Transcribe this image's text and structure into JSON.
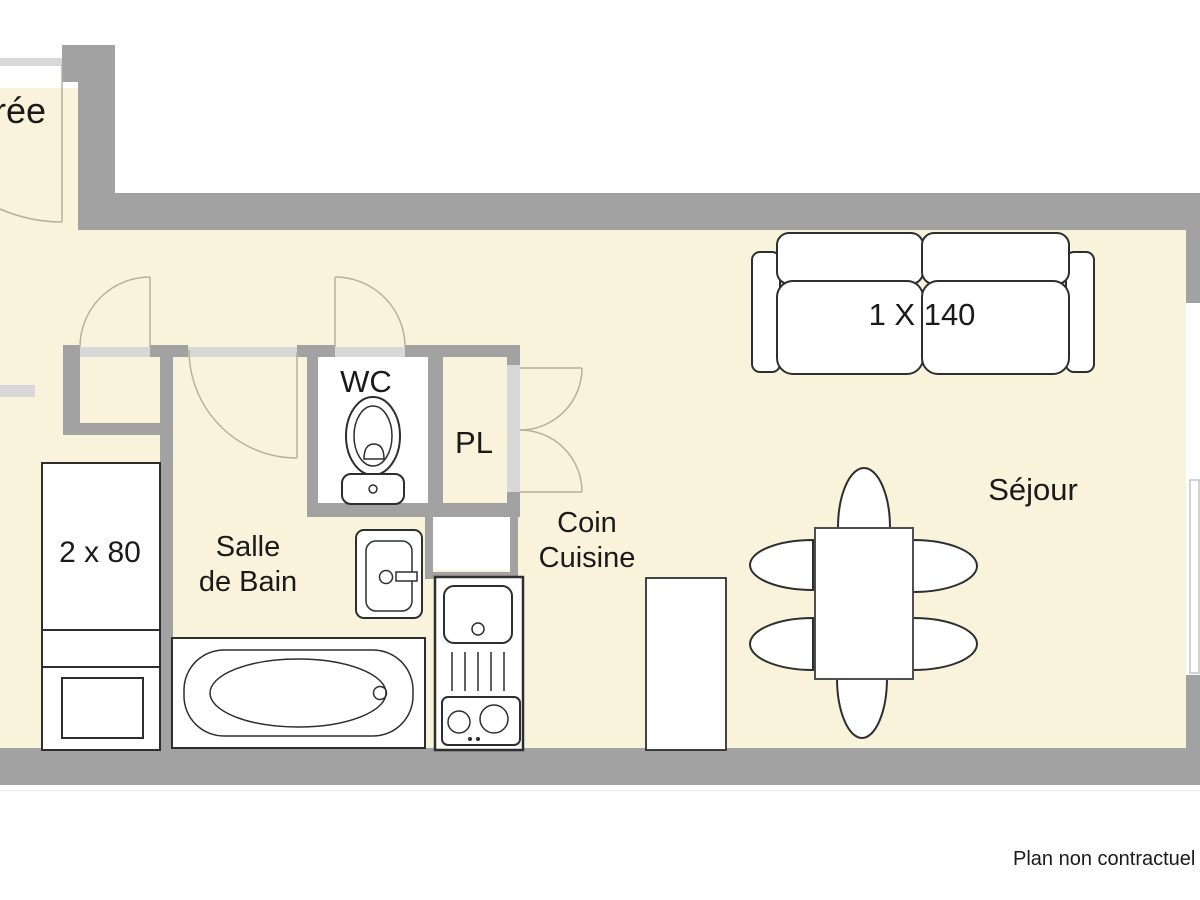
{
  "floorplan": {
    "rooms": {
      "entry": {
        "label": "rée"
      },
      "bedroom": {
        "bed_label": "2 x 80"
      },
      "bathroom": {
        "label_line1": "Salle",
        "label_line2": "de Bain"
      },
      "wc": {
        "label": "WC"
      },
      "closet": {
        "label": "PL"
      },
      "kitchen": {
        "label_line1": "Coin",
        "label_line2": "Cuisine"
      },
      "living_room": {
        "label": "Séjour",
        "sofa_label": "1 X 140"
      }
    },
    "footer": {
      "disclaimer": "Plan non contractuel"
    },
    "icons": {
      "bed": "single-bed-symbol",
      "bathtub": "bathtub-symbol",
      "washbasin": "washbasin-symbol",
      "toilet": "toilet-symbol",
      "kitchenette": "sink-and-hob-symbol",
      "fridge": "appliance-rectangle-symbol",
      "sofa_bed": "two-seat-sofa-symbol",
      "dining_table": "rectangular-table-symbol",
      "chair": "half-ellipse-chair-symbol",
      "door": "quarter-circle-door-swing",
      "window": "white-gap-in-wall"
    },
    "colors": {
      "page": "#ffffff",
      "floor": "#faf3dc",
      "wall": "#a2a2a2",
      "opening": "#d8d8d8",
      "furniture_outline": "#2e2e2e",
      "table_outline": "#4f4f4f",
      "door_arc": "#b9b099",
      "window_frame": "#c4c4c4",
      "divider": "#ececec",
      "text": "#1a1a1a"
    }
  }
}
